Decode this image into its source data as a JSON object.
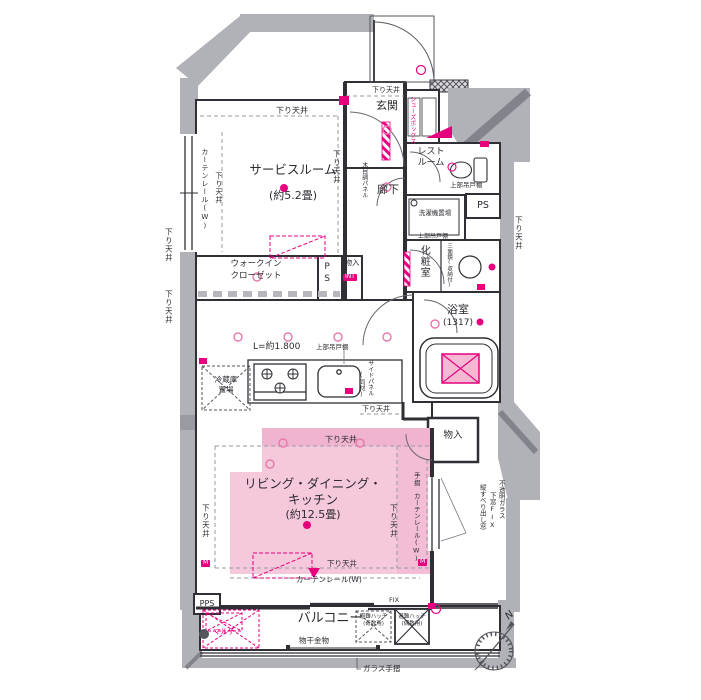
{
  "rooms": {
    "service_room": {
      "name": "サービスルーム",
      "size": "(約5.2畳)"
    },
    "ldk": {
      "name_line1": "リビング・ダイニング・",
      "name_line2": "キッチン",
      "size": "(約12.5畳)"
    },
    "entrance": {
      "name": "玄関"
    },
    "hallway": {
      "name": "廊下"
    },
    "restroom": {
      "name_line1": "レスト",
      "name_line2": "ルーム"
    },
    "powder_room": {
      "name": "化粧室"
    },
    "bathroom": {
      "name": "浴室",
      "size": "(1317)"
    },
    "walk_in_closet": {
      "name_line1": "ウォークイン",
      "name_line2": "クローゼット"
    },
    "balcony": {
      "name": "バルコニー"
    },
    "storage_hall": {
      "name": "物入",
      "badge": "INT"
    },
    "storage_ldk": {
      "name": "物入"
    },
    "pipe_space": {
      "name": "PS"
    },
    "pps": {
      "name": "PPS"
    },
    "laundry": {
      "name": "洗濯機置場"
    },
    "fridge_space": {
      "name_line1": "冷蔵庫",
      "name_line2": "置場"
    },
    "multi_space": {
      "name": "マルチ"
    }
  },
  "annotations": {
    "lowered_ceiling": "下り天井",
    "curtain_rail": "カーテンレール(W)",
    "handrail": "手摺",
    "wood_grain_panel": "木目調パネル",
    "shoe_box": "シューズボックス",
    "upper_cabinet": "上部吊戸棚",
    "kitchen_length": "L=約1.800",
    "side_panel": "サイドパネル",
    "side_panel_note": "(同材)",
    "mirror_cabinet": "三面鏡(収納付)",
    "laundry_hardware": "物干金物",
    "glass_handrail": "ガラス手摺",
    "fix_window": "FIX",
    "opaque_glass": "不透明ガラス",
    "lower_fix": "下窓FIX",
    "casement_window": "縦すべり出し窓",
    "evac_hatch": "避難ハッチ",
    "evac_hatch_odd": "(奇数用)",
    "evac_hatch_even": "(偶数用)",
    "meter": "M"
  },
  "compass": {
    "north": "N"
  },
  "colors": {
    "accent_pink": "#e6007e",
    "room_fill_pink": "#f6c8db",
    "wall_gray": "#b1b1b8"
  }
}
